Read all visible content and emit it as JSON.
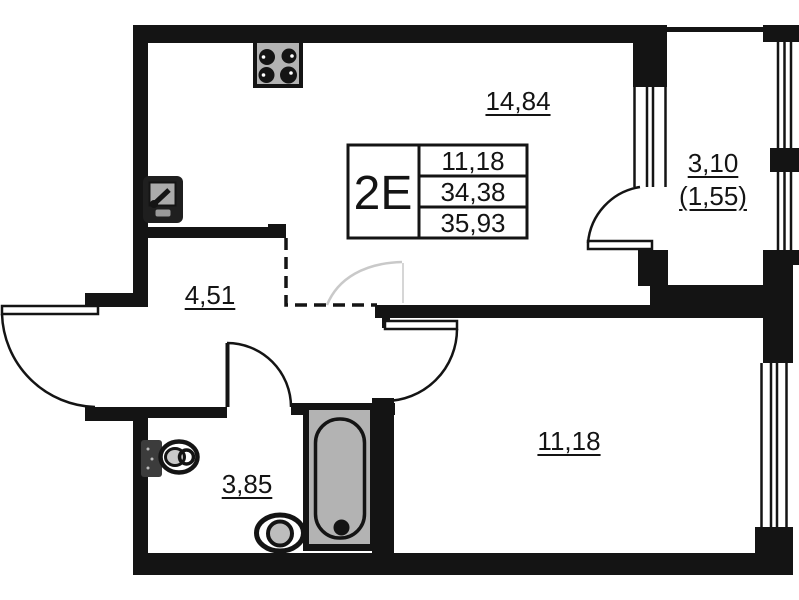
{
  "plan": {
    "info_box": {
      "unit": "2E",
      "rows": [
        "11,18",
        "34,38",
        "35,93"
      ]
    },
    "rooms": {
      "kitchen_living": "14,84",
      "loggia": "3,10",
      "loggia_reduced": "(1,55)",
      "hall": "4,51",
      "bedroom": "11,18",
      "bathroom": "3,85"
    },
    "fixtures": [
      "stove-icon",
      "kitchen-sink-icon",
      "toilet-icon",
      "bathtub-icon",
      "washbasin-icon"
    ],
    "colors": {
      "wall": "#141414",
      "fixture_gray": "#b3b3b3",
      "faint_line": "#c9c9c9",
      "background": "#ffffff"
    }
  }
}
